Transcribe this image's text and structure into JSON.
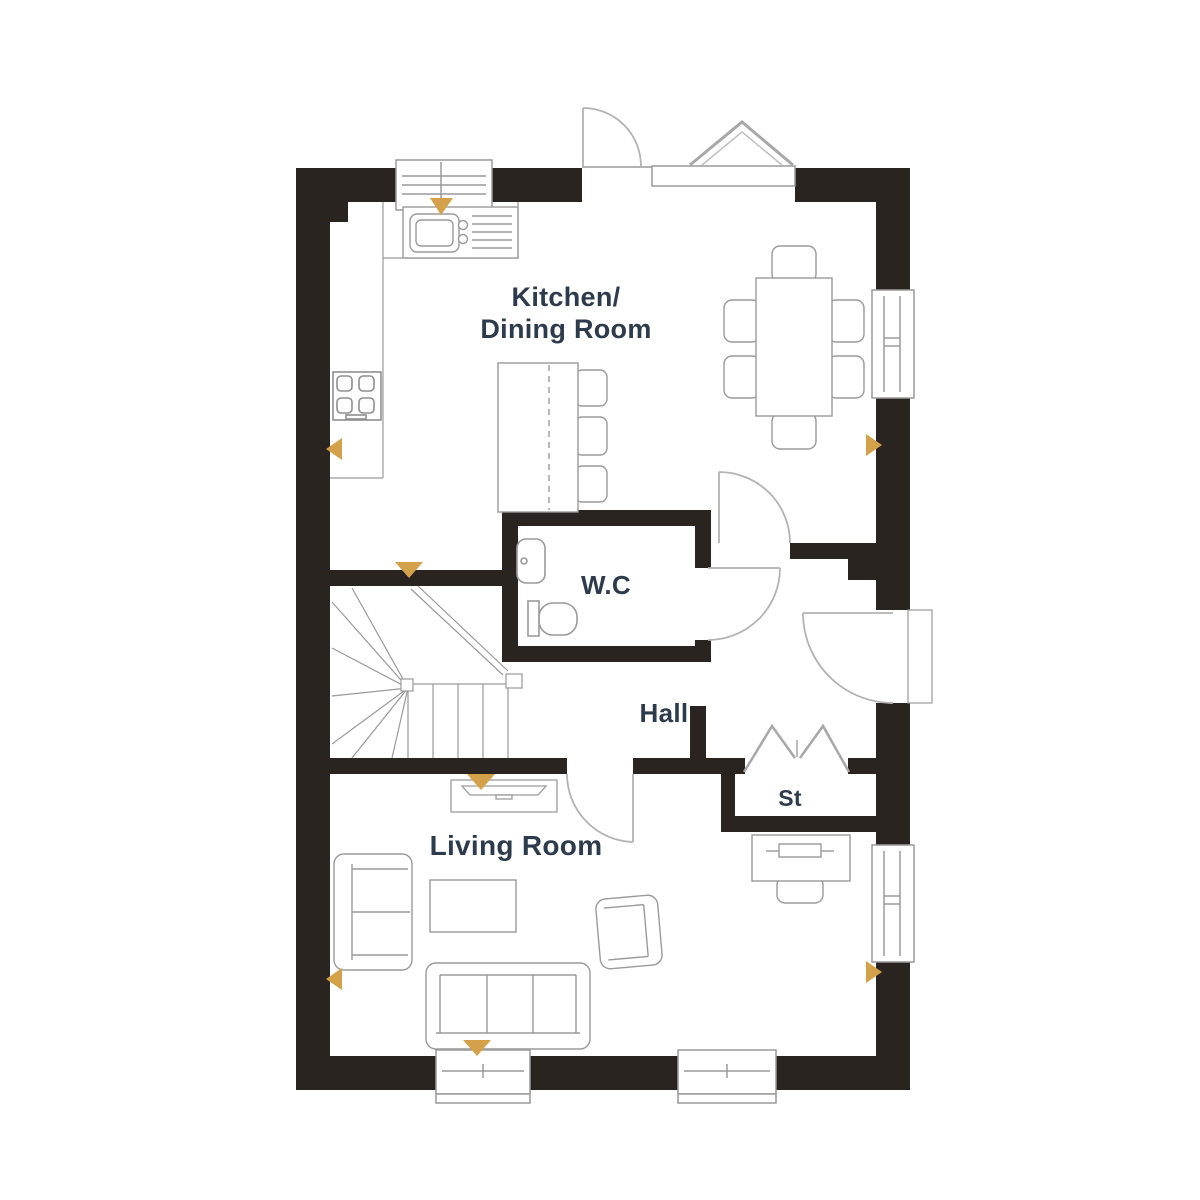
{
  "plan": {
    "type": "floor-plan",
    "rooms": {
      "kitchen_dining": {
        "label_line1": "Kitchen/",
        "label_line2": "Dining Room"
      },
      "wc": {
        "label": "W.C"
      },
      "hall": {
        "label": "Hall"
      },
      "storage": {
        "label": "St"
      },
      "living": {
        "label": "Living Room"
      }
    },
    "colors": {
      "background": "#ffffff",
      "wall": "#2a2421",
      "furniture_line": "#9a9a9a",
      "door_arc": "#b3b3b3",
      "label_text": "#2d3b4c",
      "marker": "#d2a14a"
    },
    "symbols": [
      "window",
      "door-swing",
      "bifold-door",
      "staircase-winder",
      "kitchen-sink",
      "hob",
      "breakfast-bar-with-stools",
      "dining-table-6-chairs",
      "wc-basin",
      "wc-toilet",
      "tv-unit",
      "sofa-3-seat",
      "sofa-2-seat",
      "armchair",
      "coffee-table",
      "desk-with-chair",
      "direction-marker"
    ],
    "marker_count": 8
  }
}
